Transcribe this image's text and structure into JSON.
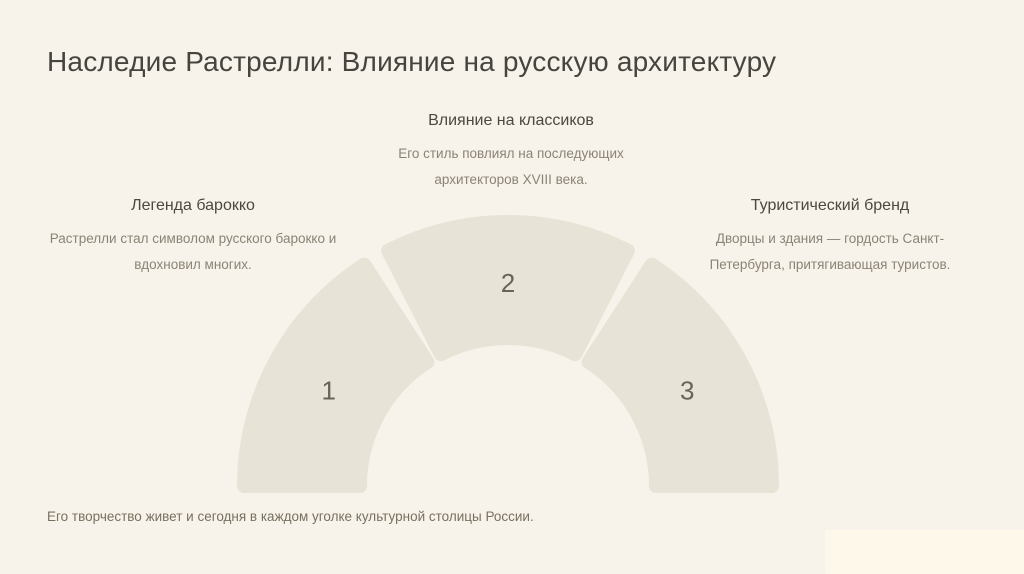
{
  "slide": {
    "title": "Наследие Растрелли: Влияние на русскую архитектуру",
    "footer": "Его творчество живет и сегодня в каждом уголке культурной столицы России."
  },
  "chart_data": {
    "type": "semicircular-segment-diagram",
    "segments": [
      {
        "number": "1",
        "label": "Легенда барокко",
        "description": "Растрелли стал символом русского барокко и\nвдохновил многих.",
        "start_angle": 180,
        "end_angle": 123
      },
      {
        "number": "2",
        "label": "Влияние на классиков",
        "description": "Его стиль повлиял на последующих\nархитекторов XVIII века.",
        "start_angle": 117,
        "end_angle": 63
      },
      {
        "number": "3",
        "label": "Туристический бренд",
        "description": "Дворцы и здания — гордость Санкт-\nПетербурга, притягивающая туристов.",
        "start_angle": 57,
        "end_angle": 0
      }
    ],
    "geometry": {
      "cx": 508,
      "cy": 486,
      "outer_radius": 264,
      "inner_radius": 148,
      "corner_stroke": 14,
      "number_radius": 203,
      "number_angles": [
        152,
        90,
        28
      ],
      "number_font_size": 26
    },
    "colors": {
      "background": "#f7f3ea",
      "segment": "#e8e3d7",
      "number": "#6a6458",
      "title": "#45443e",
      "heading": "#4b4741",
      "body": "#8b8376",
      "footer": "#78705f",
      "watermark": "#fdf8ea"
    }
  }
}
